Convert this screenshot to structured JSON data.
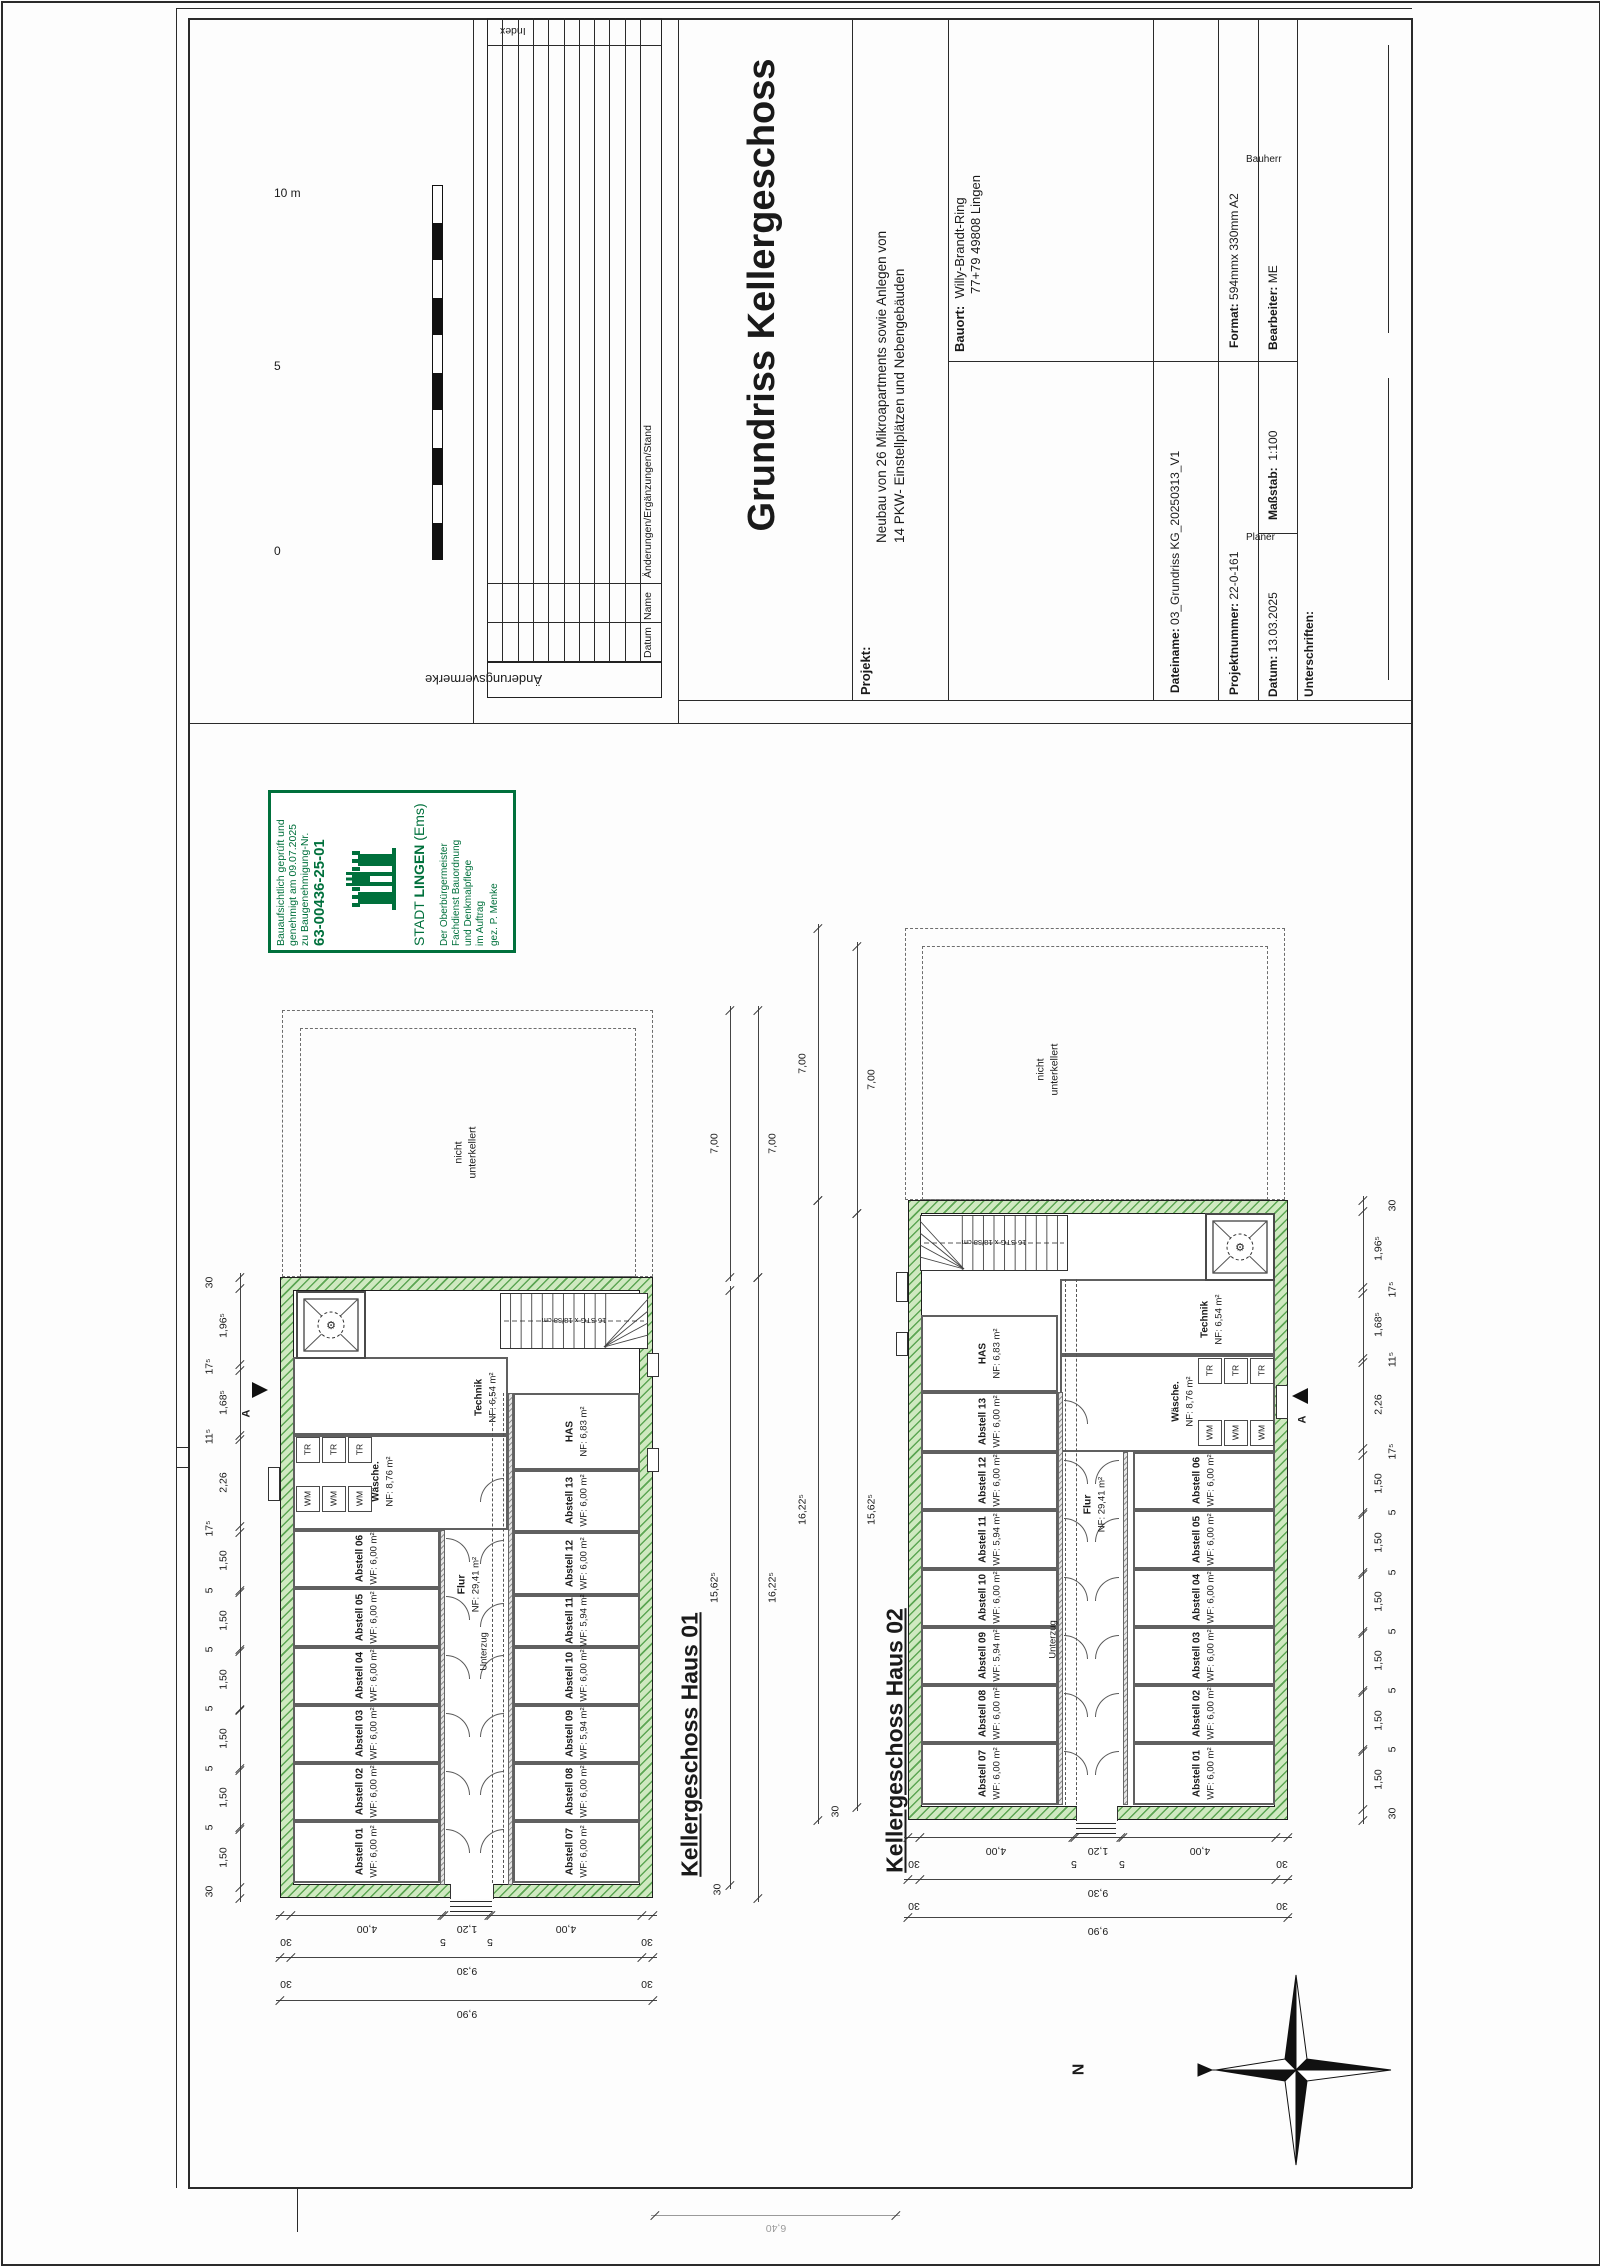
{
  "colors": {
    "stamp_green": "#00703c",
    "wall_fill": "#cfe9c0",
    "wall_hatch": "#5ca653",
    "line": "#1a1a1a"
  },
  "header": {
    "scale_bar": {
      "label_0": "0",
      "label_5": "5",
      "label_10": "10 m"
    },
    "revisions": {
      "band_title": "Änderungsvermerke",
      "col_datum": "Datum",
      "col_name": "Name",
      "col_aenderungen": "Änderungen/Ergänzungen/Stand",
      "col_index": "Index",
      "row_count": 10
    },
    "title_block": {
      "title": "Grundriss Kellergeschoss",
      "projekt_label": "Projekt:",
      "projekt_line1": "Neubau von 26 Mikroapartments sowie Anlegen von",
      "projekt_line2": "14 PKW- Einstellplätzen und Nebengebäuden",
      "bauort_label": "Bauort:",
      "bauort_line1": "Willy-Brandt-Ring",
      "bauort_line2": "77+79 49808 Lingen",
      "dateiname_label": "Dateiname:",
      "dateiname": "03_Grundriss KG_20250313_V1",
      "format_label": "Format:",
      "format": "594mmx 330mm A2",
      "projektnummer_label": "Projektnummer:",
      "projektnummer": "22-0-161",
      "bearbeiter_label": "Bearbeiter:",
      "bearbeiter": "ME",
      "massstab_label": "Maßstab:",
      "massstab": "1:100",
      "datum_label": "Datum:",
      "datum": "13.03.2025",
      "unterschriften_label": "Unterschriften:",
      "planer_label": "Planer",
      "bauherr_label": "Bauherr"
    }
  },
  "stamp": {
    "line1": "Bauaufsichtlich geprüft und",
    "line2": "genehmigt am 09.07.2025",
    "line3": "zu Baugenehmigung-Nr.",
    "number": "63-00436-25-01",
    "city_prefix": "STADT ",
    "city_bold": "LINGEN",
    "city_suffix": " (Ems)",
    "office1": "Der Oberbürgermeister",
    "office2": "Fachdienst Bauordnung",
    "office3": "und Denkmalpflege",
    "office4": "im Auftrag",
    "office5": "gez. P. Menke"
  },
  "north_label": "N",
  "houses": [
    {
      "heading": "Kellergeschoss Haus 01",
      "hx": 690,
      "hy": 1752,
      "bx": 280,
      "by": 1277,
      "bw": 373,
      "bh": 621,
      "wall": 13,
      "nicht": {
        "rect": [
          282,
          1010,
          371,
          267
        ],
        "rect2": [
          300,
          1028,
          336,
          249
        ],
        "l1": "nicht",
        "l2": "unterkellert",
        "cx": 466,
        "cy": 1153
      },
      "elev": [
        296,
        1291,
        70,
        68
      ],
      "stairs": [
        500,
        1293,
        148,
        56
      ],
      "fan": "right",
      "stairs_text": "16 STG x 18/38 cm",
      "scx": 574,
      "scy": 1321,
      "corr_bars": [
        [
          440,
          1530,
          5,
          355
        ],
        [
          508,
          1393,
          5,
          492
        ]
      ],
      "uz": [
        492,
        503
      ],
      "uzy": [
        1393,
        1883
      ],
      "flur": {
        "n": "Flur",
        "a": "NF: 29,41 m²",
        "cx": 469,
        "cy": 1585
      },
      "uzl": {
        "t": "Unterzug",
        "cx": 484,
        "cy": 1652
      },
      "rooms": [
        {
          "n": "Technik",
          "a": "NF: 6,54 m²",
          "r": [
            293,
            1357,
            215,
            78
          ],
          "lx": 486,
          "ly": 1398
        },
        {
          "n": "Wäsche.",
          "a": "NF: 8,76 m²",
          "r": [
            293,
            1435,
            215,
            95
          ],
          "lx": 383,
          "ly": 1482
        },
        {
          "n": "Abstell 06",
          "a": "WF: 6,00 m²",
          "r": [
            293,
            1530,
            147,
            58
          ]
        },
        {
          "n": "Abstell 05",
          "a": "WF: 6,00 m²",
          "r": [
            293,
            1588,
            147,
            59
          ]
        },
        {
          "n": "Abstell 04",
          "a": "WF: 6,00 m²",
          "r": [
            293,
            1647,
            147,
            58
          ]
        },
        {
          "n": "Abstell 03",
          "a": "WF: 6,00 m²",
          "r": [
            293,
            1705,
            147,
            58
          ]
        },
        {
          "n": "Abstell 02",
          "a": "WF: 6,00 m²",
          "r": [
            293,
            1763,
            147,
            58
          ]
        },
        {
          "n": "Abstell 01",
          "a": "WF: 6,00 m²",
          "r": [
            293,
            1821,
            147,
            62
          ]
        },
        {
          "n": "HAS",
          "a": "NF: 6,83 m²",
          "r": [
            513,
            1393,
            127,
            77
          ]
        },
        {
          "n": "Abstell 13",
          "a": "WF: 6,00 m²",
          "r": [
            513,
            1470,
            127,
            62
          ]
        },
        {
          "n": "Abstell 12",
          "a": "WF: 6,00 m²",
          "r": [
            513,
            1532,
            127,
            63
          ]
        },
        {
          "n": "Abstell 11",
          "a": "WF: 5,94 m²",
          "r": [
            513,
            1595,
            127,
            52
          ]
        },
        {
          "n": "Abstell 10",
          "a": "WF: 6,00 m²",
          "r": [
            513,
            1647,
            127,
            58
          ]
        },
        {
          "n": "Abstell 09",
          "a": "WF: 5,94 m²",
          "r": [
            513,
            1705,
            127,
            58
          ]
        },
        {
          "n": "Abstell 08",
          "a": "WF: 6,00 m²",
          "r": [
            513,
            1763,
            127,
            58
          ]
        },
        {
          "n": "Abstell 07",
          "a": "WF: 6,00 m²",
          "r": [
            513,
            1821,
            127,
            62
          ]
        }
      ],
      "tr": {
        "label": "TR",
        "xs": [
          296,
          322,
          348
        ],
        "y": 1437,
        "w": 24,
        "h": 26
      },
      "wm": {
        "label": "WM",
        "xs": [
          296,
          322,
          348
        ],
        "y": 1486,
        "w": 24,
        "h": 26
      },
      "entrance": [
        450,
        42
      ],
      "wells": [
        [
          647,
          1353,
          12,
          24
        ],
        [
          647,
          1448,
          12,
          24
        ],
        [
          268,
          1467,
          12,
          34
        ]
      ],
      "marker": {
        "x": 252,
        "y": 1382,
        "dir": 1,
        "label": "A",
        "lx": 247,
        "ly": 1414
      }
    },
    {
      "heading": "Kellergeschoss Haus 02",
      "hx": 895,
      "hy": 1748,
      "bx": 908,
      "by": 1200,
      "bw": 380,
      "bh": 620,
      "wall": 13,
      "nicht": {
        "rect": [
          905,
          928,
          380,
          272
        ],
        "rect2": [
          922,
          946,
          346,
          254
        ],
        "l1": "nicht",
        "l2": "unterkellert",
        "cx": 1048,
        "cy": 1070
      },
      "elev": [
        1205,
        1213,
        70,
        68
      ],
      "stairs": [
        920,
        1215,
        148,
        56
      ],
      "fan": "left",
      "stairs_text": "16 STG x 18/38 cm",
      "scx": 994,
      "scy": 1243,
      "corr_bars": [
        [
          1058,
          1392,
          5,
          413
        ],
        [
          1123,
          1452,
          5,
          353
        ]
      ],
      "uz": [
        1065,
        1076
      ],
      "uzy": [
        1279,
        1805
      ],
      "flur": {
        "n": "Flur",
        "a": "NF: 29,41 m²",
        "cx": 1095,
        "cy": 1505
      },
      "uzl": {
        "t": "Unterzug",
        "cx": 1053,
        "cy": 1640
      },
      "rooms": [
        {
          "n": "Technik",
          "a": "NF: 6,54 m²",
          "r": [
            1060,
            1279,
            215,
            76
          ],
          "lx": 1212,
          "ly": 1320
        },
        {
          "n": "Wäsche.",
          "a": "NF: 8,76 m²",
          "r": [
            1060,
            1355,
            215,
            97
          ],
          "lx": 1183,
          "ly": 1402
        },
        {
          "n": "HAS",
          "a": "NF: 6,83 m²",
          "r": [
            921,
            1315,
            137,
            77
          ]
        },
        {
          "n": "Abstell 13",
          "a": "WF: 6,00 m²",
          "r": [
            921,
            1392,
            137,
            60
          ]
        },
        {
          "n": "Abstell 12",
          "a": "WF: 6,00 m²",
          "r": [
            921,
            1452,
            137,
            58
          ]
        },
        {
          "n": "Abstell 11",
          "a": "WF: 5,94 m²",
          "r": [
            921,
            1510,
            137,
            59
          ]
        },
        {
          "n": "Abstell 10",
          "a": "WF: 6,00 m²",
          "r": [
            921,
            1569,
            137,
            58
          ]
        },
        {
          "n": "Abstell 09",
          "a": "WF: 5,94 m²",
          "r": [
            921,
            1627,
            137,
            58
          ]
        },
        {
          "n": "Abstell 08",
          "a": "WF: 6,00 m²",
          "r": [
            921,
            1685,
            137,
            58
          ]
        },
        {
          "n": "Abstell 07",
          "a": "WF: 6,00 m²",
          "r": [
            921,
            1743,
            137,
            62
          ]
        },
        {
          "n": "Abstell 06",
          "a": "WF: 6,00 m²",
          "r": [
            1133,
            1452,
            142,
            58
          ]
        },
        {
          "n": "Abstell 05",
          "a": "WF: 6,00 m²",
          "r": [
            1133,
            1510,
            142,
            59
          ]
        },
        {
          "n": "Abstell 04",
          "a": "WF: 6,00 m²",
          "r": [
            1133,
            1569,
            142,
            58
          ]
        },
        {
          "n": "Abstell 03",
          "a": "WF: 6,00 m²",
          "r": [
            1133,
            1627,
            142,
            58
          ]
        },
        {
          "n": "Abstell 02",
          "a": "WF: 6,00 m²",
          "r": [
            1133,
            1685,
            142,
            58
          ]
        },
        {
          "n": "Abstell 01",
          "a": "WF: 6,00 m²",
          "r": [
            1133,
            1743,
            142,
            62
          ]
        }
      ],
      "tr": {
        "label": "TR",
        "xs": [
          1198,
          1224,
          1250
        ],
        "y": 1358,
        "w": 24,
        "h": 26
      },
      "wm": {
        "label": "WM",
        "xs": [
          1198,
          1224,
          1250
        ],
        "y": 1420,
        "w": 24,
        "h": 26
      },
      "entrance": [
        1076,
        40
      ],
      "wells": [
        [
          896,
          1272,
          12,
          30
        ],
        [
          896,
          1332,
          12,
          24
        ],
        [
          1276,
          1385,
          12,
          34
        ]
      ],
      "marker": {
        "x": 1292,
        "y": 1388,
        "dir": -1,
        "label": "A",
        "lx": 1303,
        "ly": 1420
      }
    }
  ],
  "dims": [
    {
      "t": "v",
      "x": 240,
      "y0": 1277,
      "y1": 1898,
      "off": -16,
      "parts": [
        [
          "30",
          0.3
        ],
        [
          "1,96⁵",
          1.965
        ],
        [
          "17⁵",
          0.175
        ],
        [
          "1,68⁵",
          1.685
        ],
        [
          "11⁵",
          0.115
        ],
        [
          "2,26",
          2.26
        ],
        [
          "17⁵",
          0.175
        ],
        [
          "1,50",
          1.5
        ],
        [
          "5",
          0.05
        ],
        [
          "1,50",
          1.5
        ],
        [
          "5",
          0.05
        ],
        [
          "1,50",
          1.5
        ],
        [
          "5",
          0.05
        ],
        [
          "1,50",
          1.5
        ],
        [
          "5",
          0.05
        ],
        [
          "1,50",
          1.5
        ],
        [
          "5",
          0.05
        ],
        [
          "1,50",
          1.5
        ],
        [
          "30",
          0.3
        ]
      ]
    },
    {
      "t": "v",
      "x": 1363,
      "y0": 1200,
      "y1": 1820,
      "off": 16,
      "parts": [
        [
          "30",
          0.3
        ],
        [
          "1,96⁵",
          1.965
        ],
        [
          "17⁵",
          0.175
        ],
        [
          "1,68⁵",
          1.685
        ],
        [
          "11⁵",
          0.115
        ],
        [
          "2,26",
          2.26
        ],
        [
          "17⁵",
          0.175
        ],
        [
          "1,50",
          1.5
        ],
        [
          "5",
          0.05
        ],
        [
          "1,50",
          1.5
        ],
        [
          "5",
          0.05
        ],
        [
          "1,50",
          1.5
        ],
        [
          "5",
          0.05
        ],
        [
          "1,50",
          1.5
        ],
        [
          "5",
          0.05
        ],
        [
          "1,50",
          1.5
        ],
        [
          "5",
          0.05
        ],
        [
          "1,50",
          1.5
        ],
        [
          "30",
          0.3
        ]
      ]
    },
    {
      "t": "v",
      "x": 730,
      "y0": 1010,
      "y1": 1277,
      "off": -15,
      "parts": [
        [
          "7,00",
          7
        ]
      ]
    },
    {
      "t": "v",
      "x": 758,
      "y0": 1010,
      "y1": 1277,
      "off": 15,
      "parts": [
        [
          "7,00",
          7
        ]
      ]
    },
    {
      "t": "v",
      "x": 730,
      "y0": 1290,
      "y1": 1885,
      "off": -15,
      "parts": [
        [
          "15,62⁵",
          15.625
        ]
      ]
    },
    {
      "t": "v",
      "x": 758,
      "y0": 1277,
      "y1": 1898,
      "off": 15,
      "parts": [
        [
          "16,22⁵",
          16.225
        ]
      ]
    },
    {
      "t": "v",
      "x": 818,
      "y0": 928,
      "y1": 1200,
      "off": -15,
      "parts": [
        [
          "7,00",
          7
        ]
      ]
    },
    {
      "t": "v",
      "x": 857,
      "y0": 946,
      "y1": 1213,
      "off": 15,
      "parts": [
        [
          "7,00",
          7
        ]
      ]
    },
    {
      "t": "v",
      "x": 818,
      "y0": 1200,
      "y1": 1820,
      "off": -15,
      "parts": [
        [
          "16,22⁵",
          16.225
        ]
      ]
    },
    {
      "t": "v",
      "x": 857,
      "y0": 1213,
      "y1": 1807,
      "off": 15,
      "parts": [
        [
          "15,62⁵",
          15.625
        ]
      ]
    },
    {
      "t": "h",
      "y": 1915,
      "x0": 280,
      "x1": 653,
      "off": 6,
      "parts": [
        [
          "30",
          0.3
        ],
        [
          "4,00",
          4
        ],
        [
          "5",
          0.05
        ],
        [
          "1,20",
          1.2
        ],
        [
          "5",
          0.05
        ],
        [
          "4,00",
          4
        ],
        [
          "30",
          0.3
        ]
      ]
    },
    {
      "t": "h",
      "y": 1957,
      "x0": 280,
      "x1": 653,
      "off": 6,
      "parts": [
        [
          "30",
          0.3
        ],
        [
          "9,30",
          9.3
        ],
        [
          "30",
          0.3
        ]
      ]
    },
    {
      "t": "h",
      "y": 2000,
      "x0": 280,
      "x1": 653,
      "off": 6,
      "parts": [
        [
          "9,90",
          9.9
        ]
      ]
    },
    {
      "t": "h",
      "y": 1837,
      "x0": 908,
      "x1": 1288,
      "off": 6,
      "parts": [
        [
          "30",
          0.3
        ],
        [
          "4,00",
          4
        ],
        [
          "5",
          0.05
        ],
        [
          "1,20",
          1.2
        ],
        [
          "5",
          0.05
        ],
        [
          "4,00",
          4
        ],
        [
          "30",
          0.3
        ]
      ]
    },
    {
      "t": "h",
      "y": 1879,
      "x0": 908,
      "x1": 1288,
      "off": 6,
      "parts": [
        [
          "30",
          0.3
        ],
        [
          "9,30",
          9.3
        ],
        [
          "30",
          0.3
        ]
      ]
    },
    {
      "t": "h",
      "y": 1917,
      "x0": 908,
      "x1": 1288,
      "off": 6,
      "parts": [
        [
          "9,90",
          9.9
        ]
      ]
    },
    {
      "t": "h",
      "y": 2215,
      "x0": 655,
      "x1": 896,
      "off": 5,
      "faint": true,
      "parts": [
        [
          "6,40",
          6.4
        ]
      ]
    }
  ],
  "extra_labels": [
    [
      "30",
      718,
      1890
    ],
    [
      "30",
      836,
      1812
    ]
  ]
}
